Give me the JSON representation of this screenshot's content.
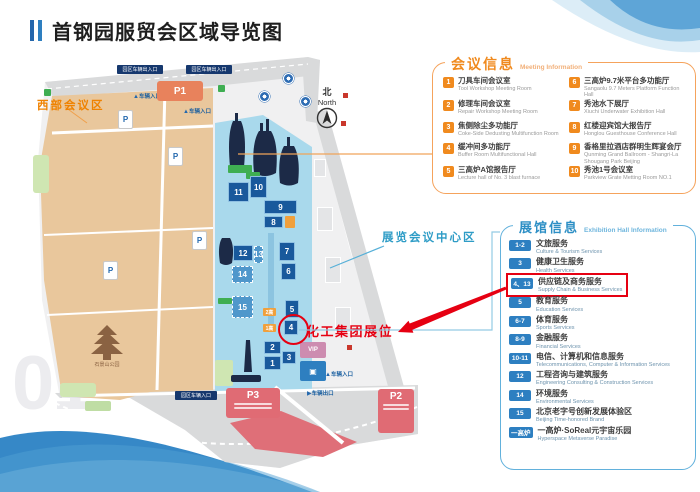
{
  "page": {
    "title": "首钢园服贸会区域导览图",
    "watermark": "01"
  },
  "map": {
    "west_area_label": "西部会议区",
    "center_area_label": "展览会议中心区",
    "north_zh": "北",
    "north_en": "North",
    "booth_annotation": "化工集团展位",
    "booths": [
      "1",
      "2",
      "3",
      "4",
      "5",
      "6",
      "7",
      "8",
      "9",
      "10",
      "11",
      "12",
      "13",
      "14",
      "15"
    ],
    "furnace_badges": [
      "2高",
      "1高"
    ],
    "parking": {
      "p1": "P1",
      "p2": "P2",
      "p3": "P3"
    },
    "vip_label": "VIP",
    "pagoda_label": "石景山公园",
    "entrances": {
      "gate_inout": "园区车辆出入口",
      "vehicle_in": "车辆入口",
      "vehicle_out": "车辆出口",
      "park_in": "园区车辆入口"
    }
  },
  "meeting_panel": {
    "title_zh": "会议信息",
    "title_en": "Meeting Information",
    "items": [
      {
        "num": "1",
        "zh": "刀具车间会议室",
        "en": "Tool Workshop Meeting Room"
      },
      {
        "num": "2",
        "zh": "修理车间会议室",
        "en": "Repair Workshop Meeting Room"
      },
      {
        "num": "3",
        "zh": "焦侧除尘多功能厅",
        "en": "Coke-Side Dedusting Multifunction Room"
      },
      {
        "num": "4",
        "zh": "缓冲间多功能厅",
        "en": "Buffer Room Multifunctional Hall"
      },
      {
        "num": "5",
        "zh": "三高炉A馆报告厅",
        "en": "Lecture hall of No. 3 blast furnace"
      },
      {
        "num": "6",
        "zh": "三高炉9.7米平台多功能厅",
        "en": "Sangaolu 9.7 Meters Platform Function Hall"
      },
      {
        "num": "7",
        "zh": "秀池水下展厅",
        "en": "Xiuchi Underwater Exhibition Hall"
      },
      {
        "num": "8",
        "zh": "红楼迎宾馆大报告厅",
        "en": "Honglou Guesthouse Conference Hall"
      },
      {
        "num": "9",
        "zh": "香格里拉酒店群明生辉宴会厅",
        "en": "Qunming Grand Ballroom - Shangri-La Shougang Park Beijing"
      },
      {
        "num": "10",
        "zh": "秀池1号会议室",
        "en": "Parkview Grate Metting Room NO.1"
      }
    ]
  },
  "exhibition_panel": {
    "title_zh": "展馆信息",
    "title_en": "Exhibition Hall Information",
    "items": [
      {
        "badge": "1-2",
        "zh": "文旅服务",
        "en": "Culture & Tourism Services",
        "highlighted": false
      },
      {
        "badge": "3",
        "zh": "健康卫生服务",
        "en": "Health Services",
        "highlighted": false
      },
      {
        "badge": "4、13",
        "zh": "供应链及商务服务",
        "en": "Supply Chain & Business Services",
        "highlighted": true
      },
      {
        "badge": "5",
        "zh": "教育服务",
        "en": "Education Services",
        "highlighted": false
      },
      {
        "badge": "6-7",
        "zh": "体育服务",
        "en": "Sports Services",
        "highlighted": false
      },
      {
        "badge": "8-9",
        "zh": "金融服务",
        "en": "Financial Services",
        "highlighted": false
      },
      {
        "badge": "10-11",
        "zh": "电信、计算机和信息服务",
        "en": "Telecommunications, Computer & Information Services",
        "highlighted": false
      },
      {
        "badge": "12",
        "zh": "工程咨询与建筑服务",
        "en": "Engineering Consulting & Construction Services",
        "highlighted": false
      },
      {
        "badge": "14",
        "zh": "环境服务",
        "en": "Environmental Services",
        "highlighted": false
      },
      {
        "badge": "15",
        "zh": "北京老字号创新发展体验区",
        "en": "Beijing Time-honored Brand",
        "highlighted": false
      },
      {
        "badge": "一高炉",
        "zh": "一高炉·SoReal元宇宙乐园",
        "en": "Hyperspace Metaverse Paradise",
        "highlighted": false
      }
    ]
  },
  "colors": {
    "accent_orange": "#f08a1e",
    "accent_blue": "#2d8fc5",
    "highlight_red": "#e60012"
  }
}
